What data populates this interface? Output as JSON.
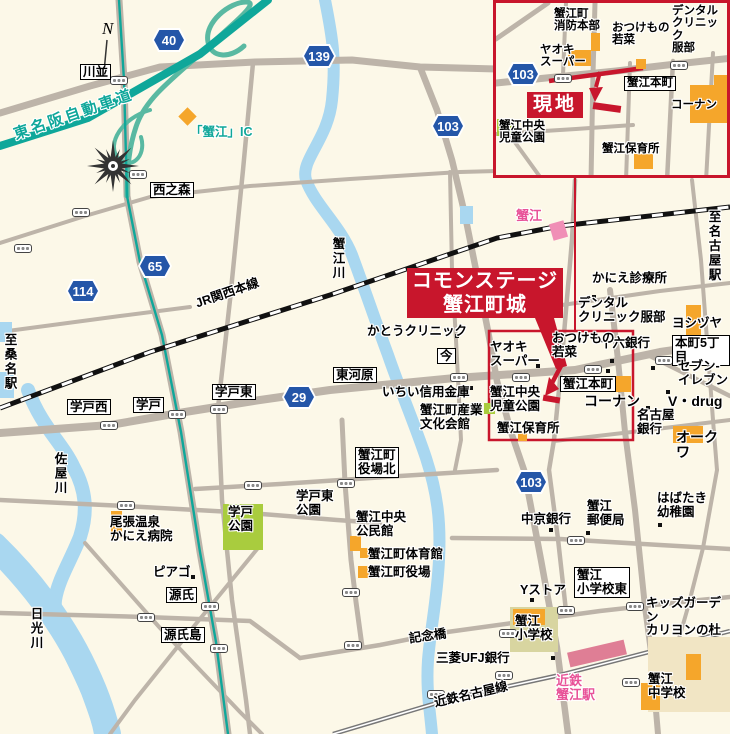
{
  "banner": {
    "text": "コモンステージ\n蟹江町城"
  },
  "inset": {
    "site": "現地",
    "fire_hq": "蟹江町\n消防本部",
    "wakana": "おつけもの\n若菜",
    "dental": "デンタル\nクリニック\n服部",
    "yaoki": "ヤオキ\nスーパー",
    "route_103": "103",
    "honmachi": "蟹江本町",
    "kohnan": "コーナン",
    "children_park": "蟹江中央\n児童公園",
    "nursery": "蟹江保育所"
  },
  "shields": {
    "r40": "40",
    "r139": "139",
    "r103_top": "103",
    "r65": "65",
    "r114": "114",
    "r29": "29",
    "r103_south": "103"
  },
  "labels": {
    "compass_n": "N",
    "kawanami": "川並",
    "tomeihan": "東名阪自動車道",
    "kanie_ic": "「蟹江」IC",
    "nishinomori": "西之森",
    "kaniegawa": "蟹江川",
    "jr_line": "JR関西本線",
    "kanie_station": "蟹江",
    "to_nagoya": "至名古屋駅",
    "to_kuwana": "至桑名駅",
    "clinic_kanie": "かにえ診療所",
    "dental": "デンタル\nクリニック服部",
    "yoshizuya": "ヨシヅヤ",
    "honmachi5": "本町5丁目",
    "juroku_bank": "十六銀行",
    "seven_eleven": "セブン-\nイレブン",
    "vdrug": "V・drug",
    "nagoya_bank": "名古屋\n銀行",
    "okuwa": "オークワ",
    "kato_clinic": "かとうクリニック",
    "ima": "今",
    "higashikawara": "東河原",
    "yaoki": "ヤオキ\nスーパー",
    "wakana": "おつけもの\n若菜",
    "kanie_honmachi": "蟹江本町",
    "kohnan": "コーナン",
    "ichii_bank": "いちい信用金庫",
    "sangyo_hall": "蟹江町産業\n文化会館",
    "children_park": "蟹江中央\n児童公園",
    "nursery": "蟹江保育所",
    "gakuto_higashi": "学戸東",
    "gakuto": "学戸",
    "gakuto_nishi": "学戸西",
    "sayagawa": "佐屋川",
    "yakuba_kita": "蟹江町\n役場北",
    "gakuto_higashi_park": "学戸東\n公園",
    "gakuto_park": "学戸\n公園",
    "onsen_hospital": "尾張温泉\nかにえ病院",
    "piago": "ピアゴ",
    "genji": "源氏",
    "genjijima": "源氏島",
    "nikkogawa": "日光川",
    "kominkan": "蟹江中央\n公民館",
    "gym": "蟹江町体育館",
    "yakuba": "蟹江町役場",
    "chukyo_bank": "中京銀行",
    "post_office": "蟹江\n郵便局",
    "habataki": "はばたき\n幼稚園",
    "y_store": "Yストア",
    "shogakko_higashi": "蟹江\n小学校東",
    "kids_garden": "キッズガーデン\nカリヨンの杜",
    "kinenbashi": "記念橋",
    "mufg": "三菱UFJ銀行",
    "shogakko": "蟹江\n小学校",
    "kintetsu_line": "近鉄名古屋線",
    "kintetsu_station": "近鉄\n蟹江駅",
    "chugakko": "蟹江\n中学校"
  },
  "colors": {
    "accent_red": "#C8162C",
    "expressway_teal": "#0FA79A",
    "route_shield_blue": "#2456A8",
    "building_orange": "#F5A62B",
    "park_green": "#A9CC3E",
    "river_blue": "#A9D7F0",
    "station_pink": "#E85298",
    "road_gray": "#BDB4A9"
  }
}
